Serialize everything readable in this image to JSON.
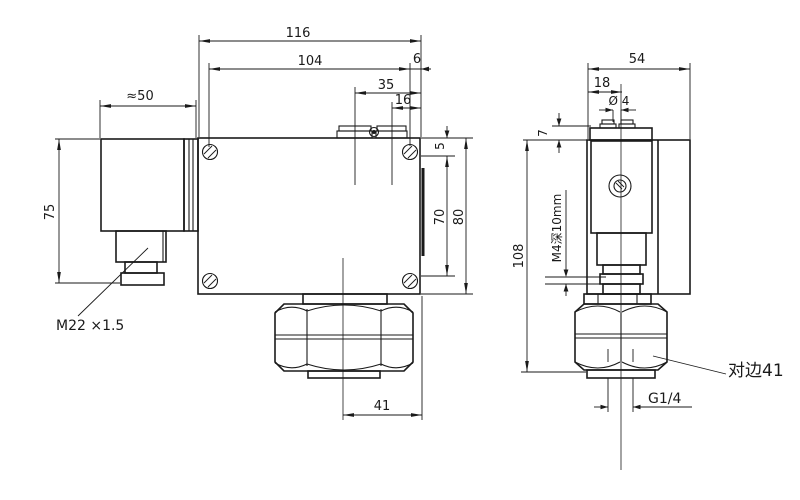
{
  "colors": {
    "ink": "#1a1a1a",
    "paper": "#ffffff"
  },
  "front": {
    "total_width": "116",
    "mount_span": "104",
    "edge_offset": "6",
    "terminal_span": "35",
    "terminal_inner": "16",
    "cable_len": "≈50",
    "connector_height": "75",
    "top_gap": "5",
    "vert_span": "70",
    "total_height": "80",
    "port_offset": "41",
    "conduit_thread": "M22 ×1.5"
  },
  "side": {
    "total_depth": "54",
    "screw_offset": "18",
    "screw_dia": "Ø 4",
    "cover_height": "7",
    "total_height": "108",
    "mount_thread": "M4深10mm",
    "across_flats": "对边41",
    "port_thread": "G1/4"
  }
}
